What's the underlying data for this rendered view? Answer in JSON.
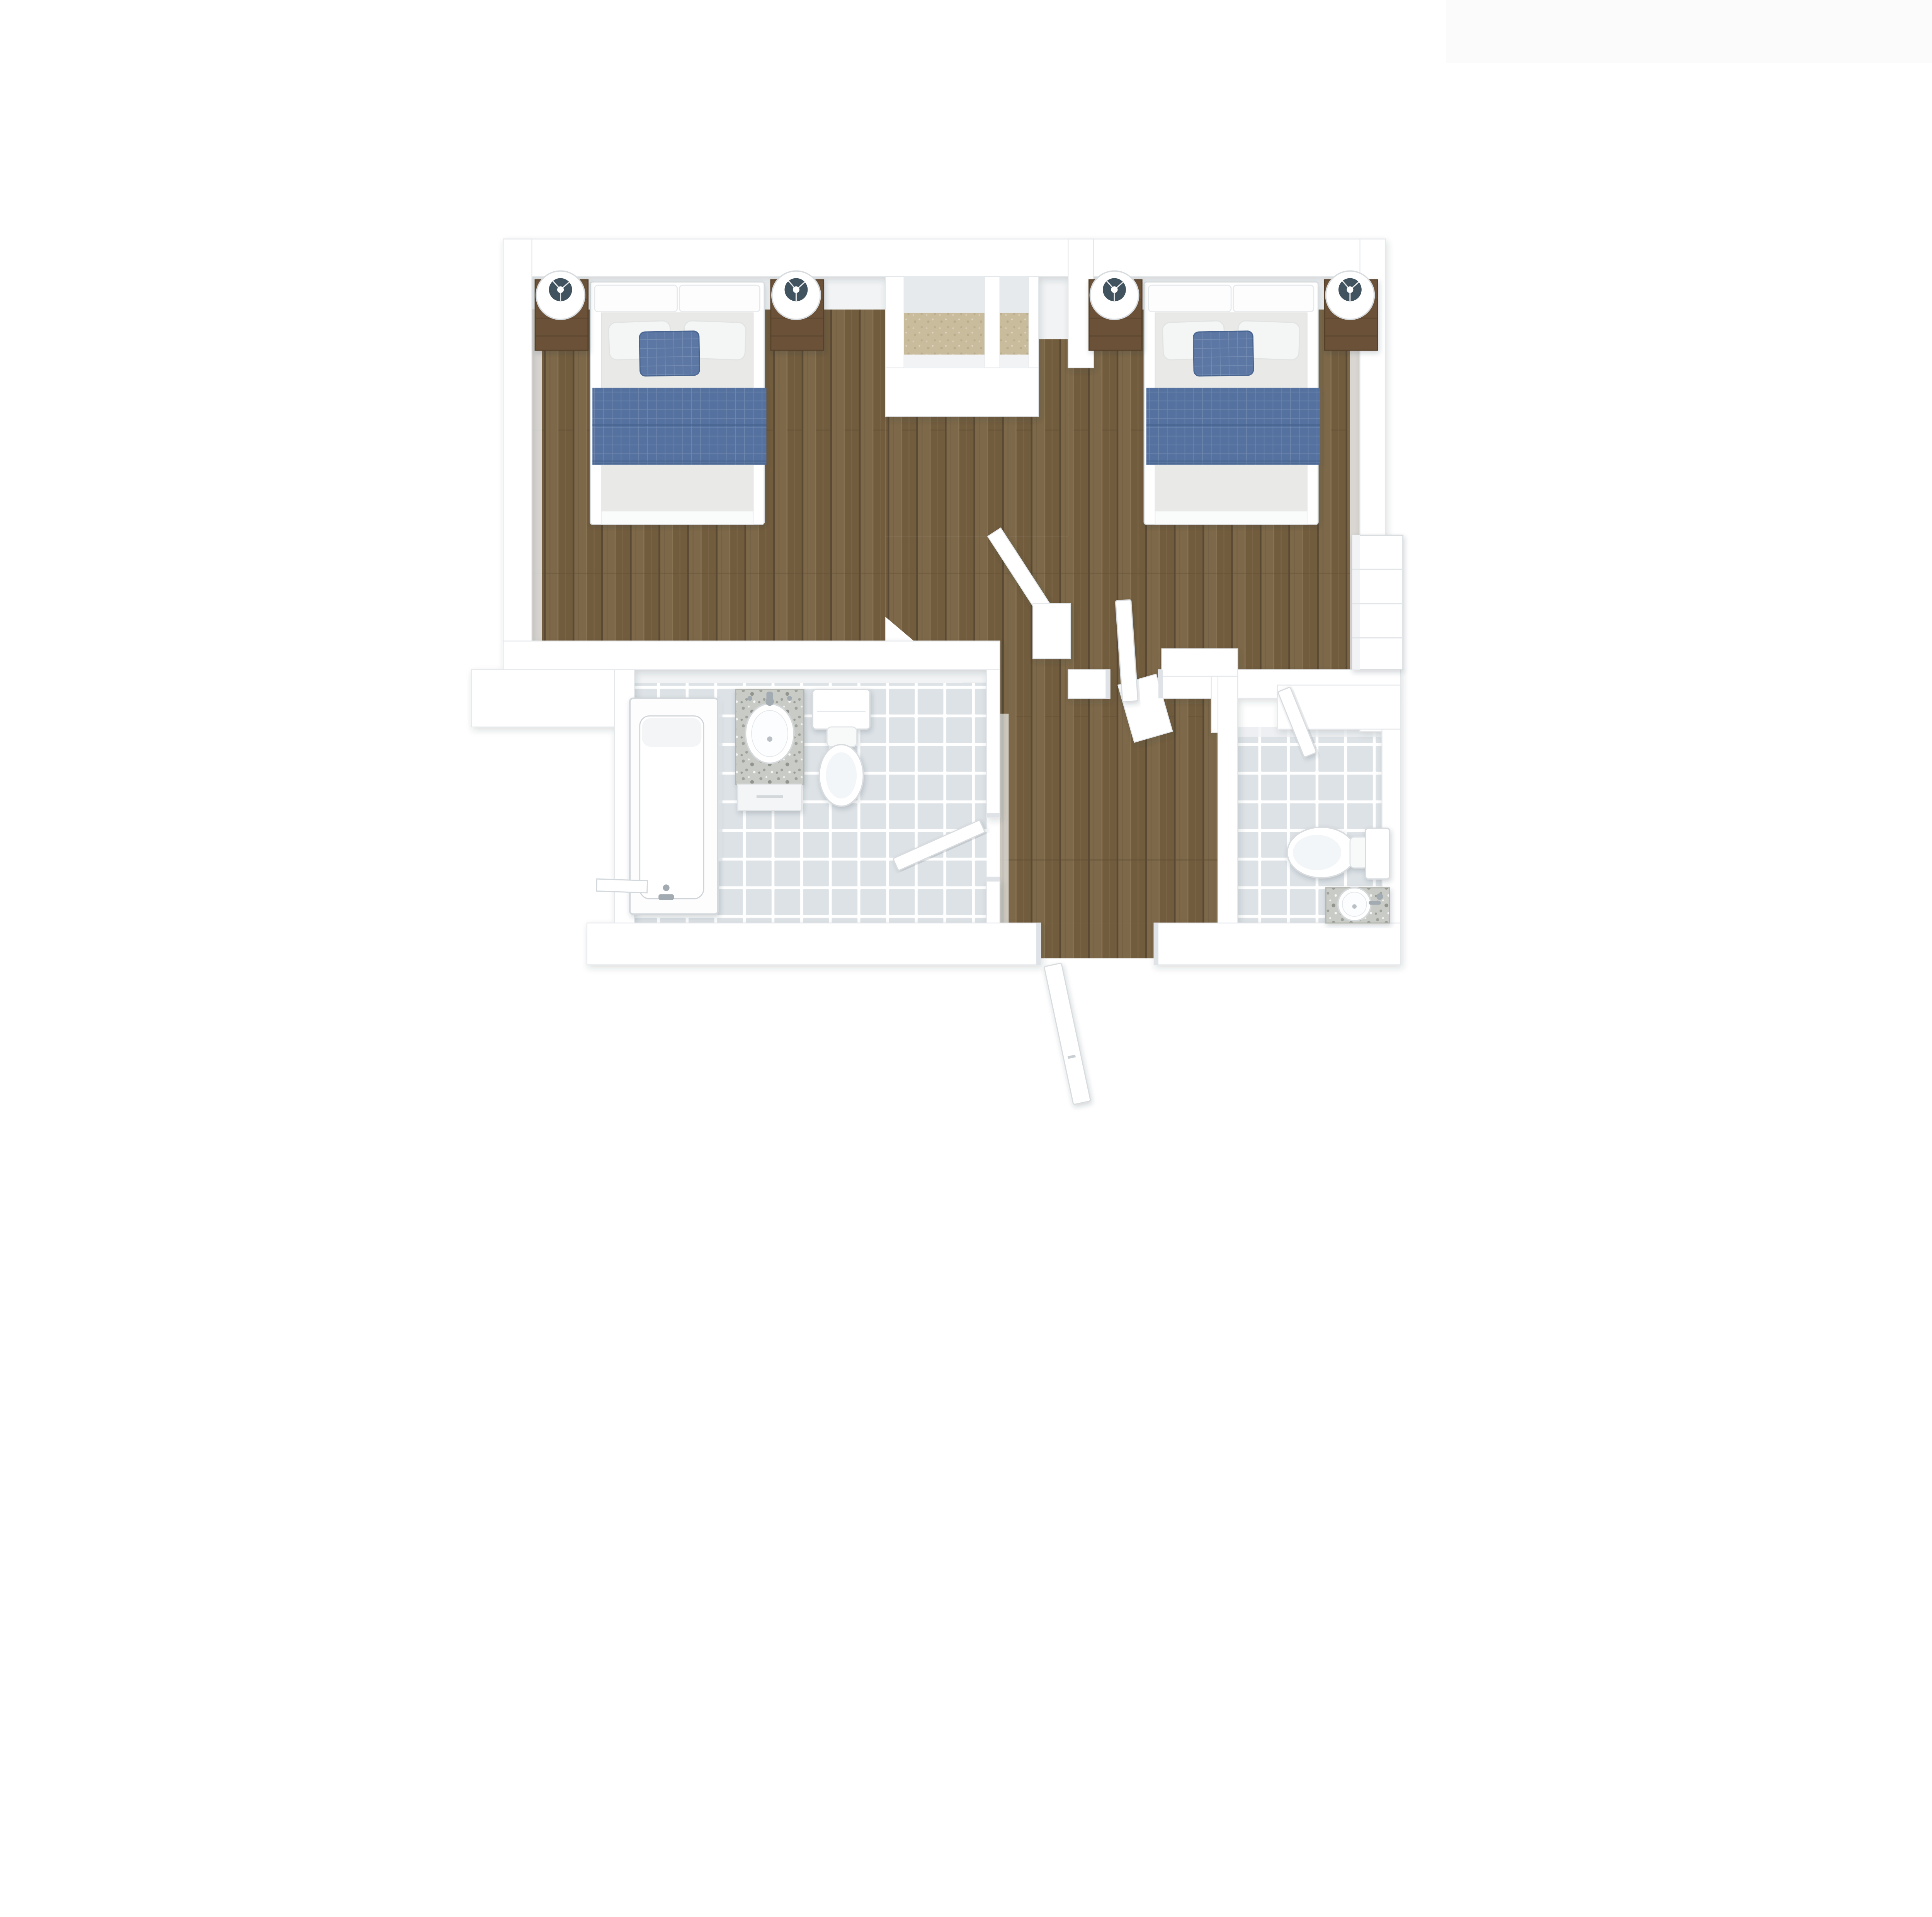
{
  "meta": {
    "title": "3D rendered floor plan, top-down view",
    "view": "orthographic top-down 3D render",
    "visible_text": ""
  },
  "theme": {
    "colors": {
      "page-bg": "#ffffff",
      "faint-band": "#fbfbfc",
      "wall-fill": "#ffffff",
      "wall-stroke": "#e5e8eb",
      "wall-face": "#f1f3f5",
      "wall-face-dark": "#e7eaed",
      "jamb": "#dfe3e7",
      "wood-a": "#7d6849",
      "wood-b": "#725c3e",
      "wood-seam": "#5a4a33",
      "wood-hi": "#8f7b59",
      "carpet": "#c9bc9d",
      "carpet-dot": "#b3a583",
      "tile": "#dde2e6",
      "grout": "#ffffff",
      "fixture-white": "#ffffff",
      "fixture-stroke": "#d8dcdf",
      "tub-stroke": "#d3d8dc",
      "mattress": "#e9e9e7",
      "pillow": "#f4f5f5",
      "blanket": "#54719f",
      "blanket-dark": "#47648f",
      "pillow-accent": "#5b77a4",
      "nightstand": "#6a5138",
      "nightstand-dark": "#55402a",
      "lamp-inner": "#41535f",
      "granite-a": "#c9cbc6",
      "granite-b": "#9fa29b",
      "granite-c": "#84877f",
      "chrome": "#a3abb2",
      "glass": "#dce2e6"
    }
  },
  "plan": {
    "rooms": [
      {
        "id": "bedroom-left",
        "type": "bedroom",
        "floor": "wood planks",
        "furniture": [
          "double bed with white frame, grey mattress, two white pillows, blue accent pillow, blue blanket",
          "2 dark wood nightstands",
          "2 round white table lamps"
        ]
      },
      {
        "id": "bedroom-right",
        "type": "bedroom",
        "floor": "wood planks",
        "furniture": [
          "double bed with white frame, grey mattress, two white pillows, blue accent pillow, blue blanket",
          "2 dark wood nightstands",
          "2 round white table lamps",
          "white dresser against right wall"
        ]
      },
      {
        "id": "closet-left",
        "type": "closet",
        "floor": "beige carpet"
      },
      {
        "id": "closet-right",
        "type": "closet",
        "floor": "beige carpet"
      },
      {
        "id": "bathroom-left",
        "type": "bathroom",
        "floor": "white tile",
        "fixtures": [
          "bathtub with shower glass",
          "granite-top vanity with oval sink",
          "toilet"
        ]
      },
      {
        "id": "bathroom-right",
        "type": "bathroom",
        "floor": "white tile",
        "fixtures": [
          "toilet",
          "granite-top vanity with round sink"
        ]
      },
      {
        "id": "hallway",
        "type": "hallway",
        "floor": "wood planks"
      }
    ],
    "doors": [
      {
        "id": "door-bedroom-right",
        "state": "open"
      },
      {
        "id": "door-bathroom-left",
        "state": "open"
      },
      {
        "id": "door-bathroom-right",
        "state": "open"
      },
      {
        "id": "door-entry-bottom",
        "state": "open"
      }
    ],
    "counts": {
      "bedrooms": 2,
      "bathrooms": 2,
      "closets": 2,
      "beds": 2,
      "nightstands": 4,
      "lamps": 4,
      "toilets": 2,
      "sinks": 2,
      "bathtubs": 1,
      "dressers": 1,
      "open-doors": 4
    }
  }
}
